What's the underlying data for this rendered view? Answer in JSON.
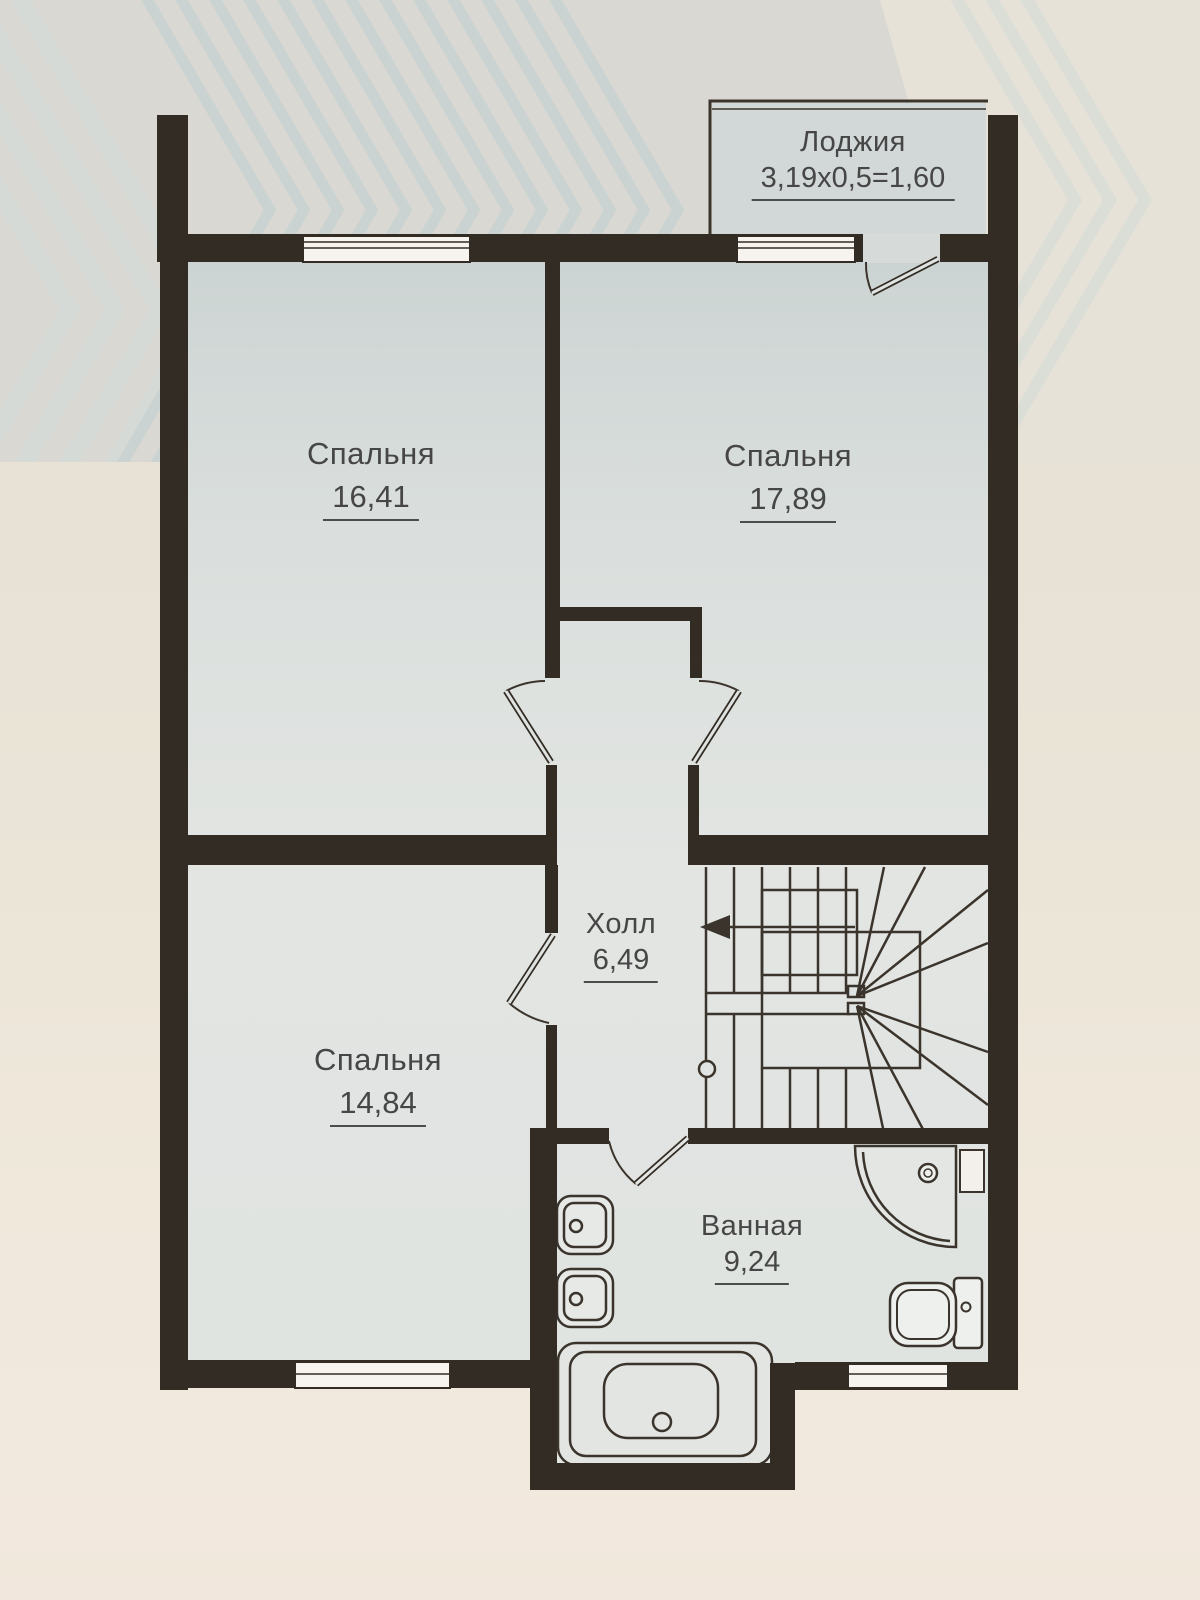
{
  "plan": {
    "title": "Floor plan — second level",
    "rooms": [
      {
        "id": "loggia",
        "name": "Лоджия",
        "area": "3,19x0,5=1,60"
      },
      {
        "id": "bedroom1",
        "name": "Спальня",
        "area": "16,41"
      },
      {
        "id": "bedroom2",
        "name": "Спальня",
        "area": "17,89"
      },
      {
        "id": "hall",
        "name": "Холл",
        "area": "6,49"
      },
      {
        "id": "bedroom3",
        "name": "Спальня",
        "area": "14,84"
      },
      {
        "id": "bathroom",
        "name": "Ванная",
        "area": "9,24"
      }
    ],
    "colors": {
      "wall": "#332c24",
      "floor": "#dde1df",
      "paper": "#ece6d9",
      "line": "#3b342c",
      "text": "#464646"
    }
  }
}
